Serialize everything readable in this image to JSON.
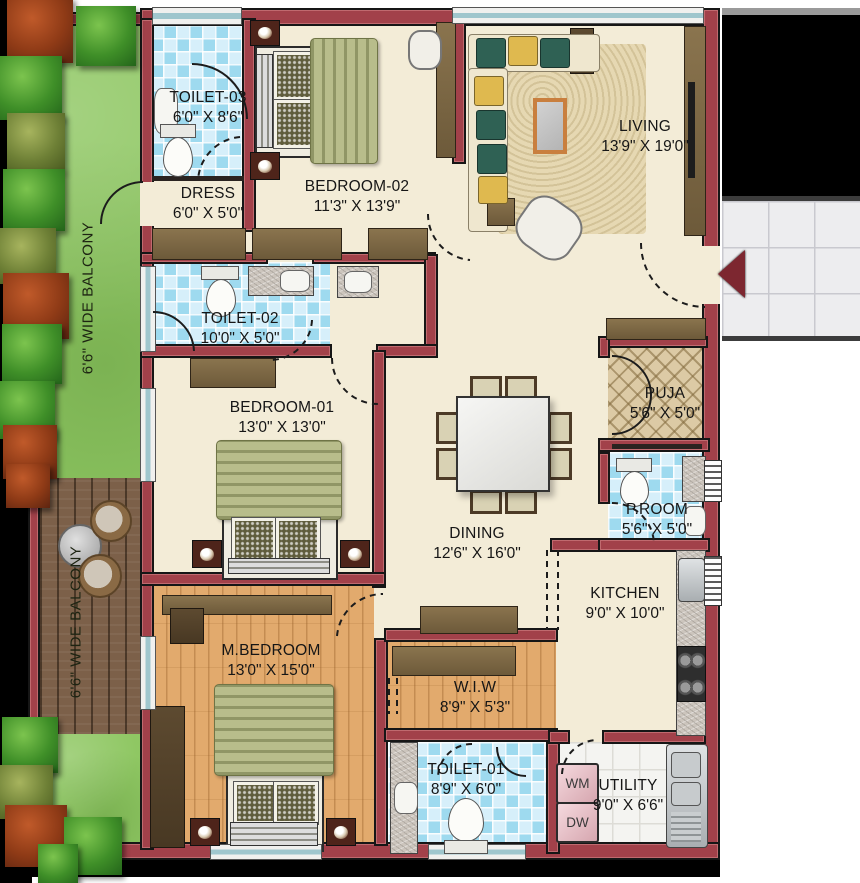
{
  "type": "residential-floor-plan",
  "rooms": {
    "toilet3": {
      "name": "TOILET-03",
      "dims": "6'0\" X 8'6\""
    },
    "dress": {
      "name": "DRESS",
      "dims": "6'0\" X 5'0\""
    },
    "bedroom2": {
      "name": "BEDROOM-02",
      "dims": "11'3\" X 13'9\""
    },
    "living": {
      "name": "LIVING",
      "dims": "13'9\" X 19'0\""
    },
    "toilet2": {
      "name": "TOILET-02",
      "dims": "10'0\" X 5'0\""
    },
    "bedroom1": {
      "name": "BEDROOM-01",
      "dims": "13'0\" X 13'0\""
    },
    "puja": {
      "name": "PUJA",
      "dims": "5'6\" X 5'0\""
    },
    "proom": {
      "name": "P.ROOM",
      "dims": "5'6\" X 5'0\""
    },
    "dining": {
      "name": "DINING",
      "dims": "12'6\" X 16'0\""
    },
    "kitchen": {
      "name": "KITCHEN",
      "dims": "9'0\" X 10'0\""
    },
    "mbedroom": {
      "name": "M.BEDROOM",
      "dims": "13'0\" X 15'0\""
    },
    "wiw": {
      "name": "W.I.W",
      "dims": "8'9\" X 5'3\""
    },
    "toilet1": {
      "name": "TOILET-01",
      "dims": "8'9\" X 6'0\""
    },
    "utility": {
      "name": "UTILITY",
      "dims": "9'0\" X 6'6\""
    }
  },
  "balcony_upper": {
    "label": "6'6\" WIDE BALCONY"
  },
  "balcony_lower": {
    "label": "6'6\" WIDE BALCONY"
  },
  "appliances": {
    "washing_machine": "WM",
    "dishwasher": "DW"
  },
  "colors": {
    "wall": "#a2414a",
    "floor": "#f3ecd7",
    "bath_tile": "#9edaef",
    "grass": "#8fc763",
    "deck_wood": "#7c6049",
    "plank_wood": "#e2aa6d",
    "entry_arrow": "#7d2730"
  }
}
